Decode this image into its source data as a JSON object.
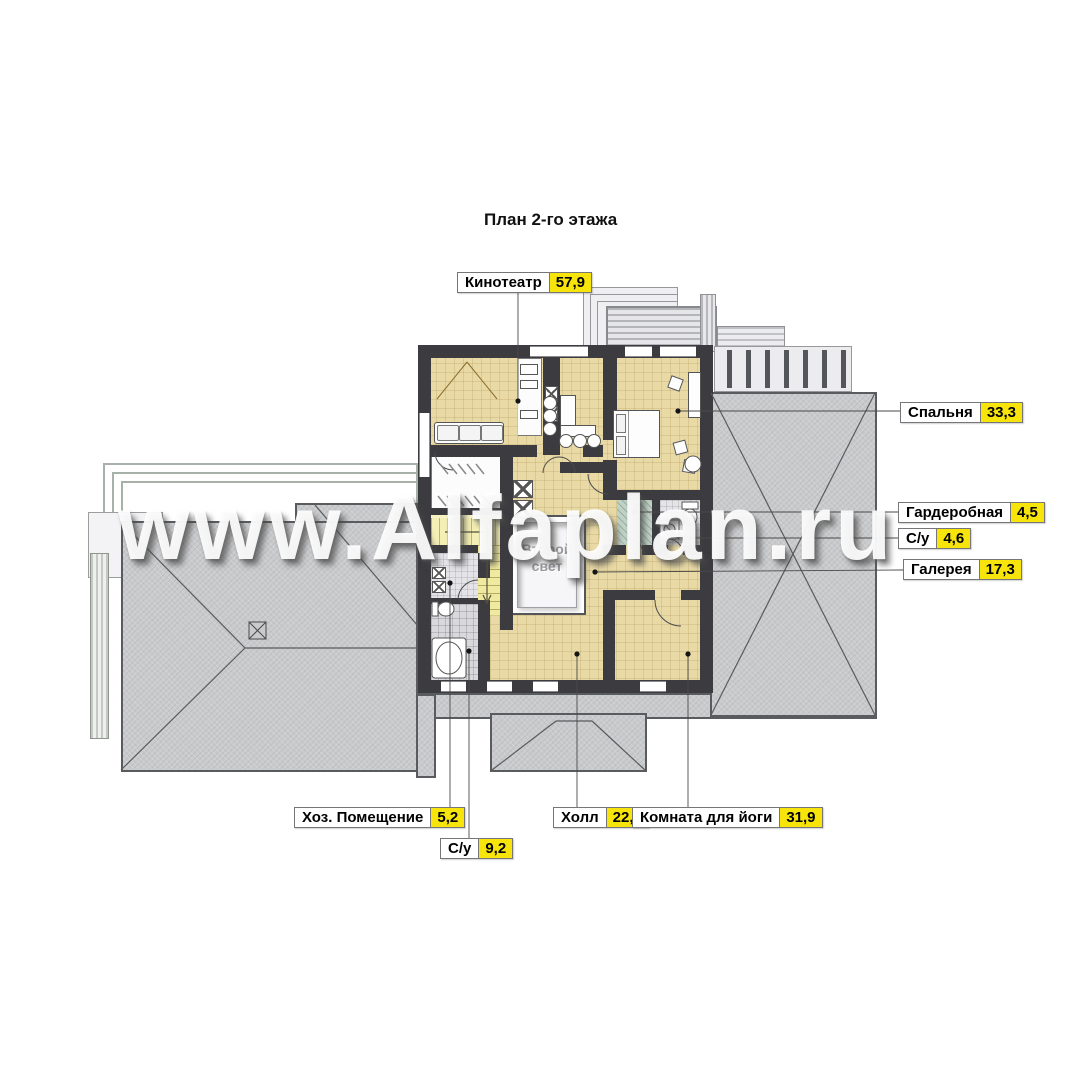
{
  "title": "План 2-го этажа",
  "watermark": "www.Alfaplan.ru",
  "plan": {
    "second_light": "Второй\nсвет",
    "rooms": [
      {
        "id": "kinoteatr",
        "name": "Кинотеатр",
        "area": "57,9"
      },
      {
        "id": "spalnya",
        "name": "Спальня",
        "area": "33,3"
      },
      {
        "id": "garderobnaya",
        "name": "Гардеробная",
        "area": "4,5"
      },
      {
        "id": "su-top",
        "name": "С/у",
        "area": "4,6"
      },
      {
        "id": "galereya",
        "name": "Галерея",
        "area": "17,3"
      },
      {
        "id": "hoz",
        "name": "Хоз. Помещение",
        "area": "5,2"
      },
      {
        "id": "su-bottom",
        "name": "С/у",
        "area": "9,2"
      },
      {
        "id": "holl",
        "name": "Холл",
        "area": "22,1"
      },
      {
        "id": "yoga",
        "name": "Комната для йоги",
        "area": "31,9"
      }
    ]
  },
  "colors": {
    "label_value_bg": "#f6e40a",
    "floor_beige": "#e8d9a5",
    "roof_gray": "#c9cacc",
    "wall_dark": "#3c3c40"
  }
}
